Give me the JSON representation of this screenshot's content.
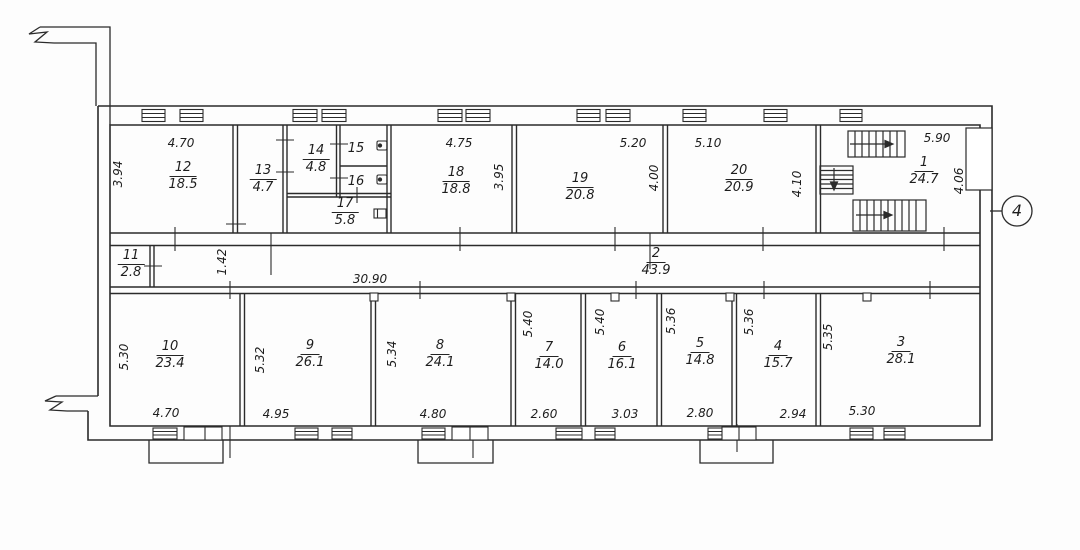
{
  "plan": {
    "axis_label": "4",
    "ink_color": "#2b2b2b",
    "rooms": {
      "1": {
        "number": "1",
        "area": "24.7"
      },
      "2": {
        "number": "2",
        "area": "43.9"
      },
      "3": {
        "number": "3",
        "area": "28.1"
      },
      "4": {
        "number": "4",
        "area": "15.7"
      },
      "5": {
        "number": "5",
        "area": "14.8"
      },
      "6": {
        "number": "6",
        "area": "16.1"
      },
      "7": {
        "number": "7",
        "area": "14.0"
      },
      "8": {
        "number": "8",
        "area": "24.1"
      },
      "9": {
        "number": "9",
        "area": "26.1"
      },
      "10": {
        "number": "10",
        "area": "23.4"
      },
      "11": {
        "number": "11",
        "area": "2.8"
      },
      "12": {
        "number": "12",
        "area": "18.5"
      },
      "13": {
        "number": "13",
        "area": "4.7"
      },
      "14": {
        "number": "14",
        "area": "4.8"
      },
      "15": {
        "number": "15"
      },
      "16": {
        "number": "16"
      },
      "17": {
        "number": "17",
        "area": "5.8"
      },
      "18": {
        "number": "18",
        "area": "18.8"
      },
      "19": {
        "number": "19",
        "area": "20.8"
      },
      "20": {
        "number": "20",
        "area": "20.9"
      }
    },
    "dimensions": {
      "r12_top": "4.70",
      "r12_side": "3.94",
      "r18_top": "4.75",
      "r18_side": "3.95",
      "r19_top": "5.20",
      "r19_side": "4.00",
      "r20_top": "5.10",
      "r20_side": "4.10",
      "r1_top": "5.90",
      "r1_side": "4.06",
      "corridor_width": "1.42",
      "corridor_length": "30.90",
      "r10_side": "5.30",
      "r10_bottom": "4.70",
      "r9_side": "5.32",
      "r9_bottom": "4.95",
      "r8_side": "5.34",
      "r8_bottom": "4.80",
      "r7_side": "5.40",
      "r7_bottom": "2.60",
      "r6_side": "5.40",
      "r6_bottom": "3.03",
      "r5_side": "5.36",
      "r5_bottom": "2.80",
      "r4_side": "5.36",
      "r4_bottom": "2.94",
      "r3_side": "5.35",
      "r3_bottom": "5.30"
    }
  }
}
